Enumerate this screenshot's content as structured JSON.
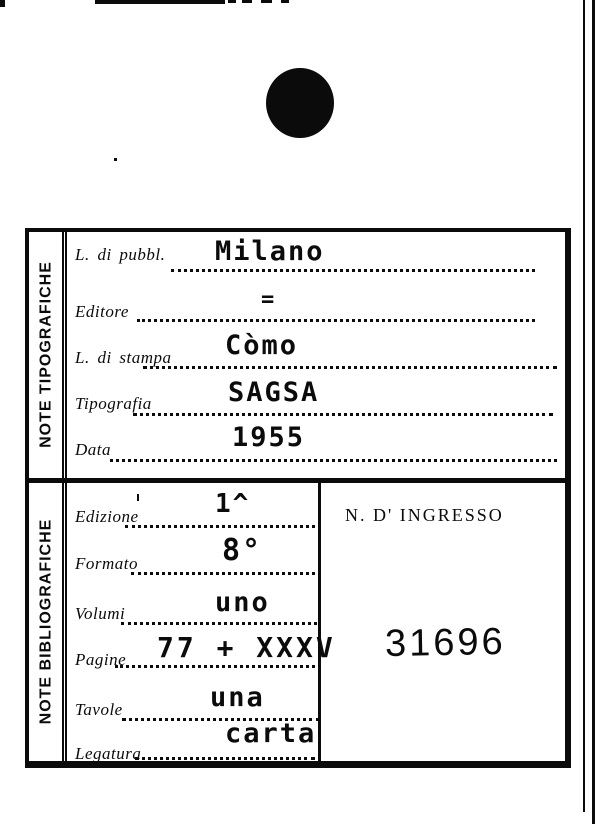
{
  "card": {
    "strip_top_label": "NOTE TIPOGRAFICHE",
    "strip_bottom_label": "NOTE BIBLIOGRAFICHE",
    "fields_top": [
      {
        "label": "L. di pubbl.",
        "value": "Milano"
      },
      {
        "label": "Editore",
        "value": "="
      },
      {
        "label": "L. di stampa",
        "value": "Còmo"
      },
      {
        "label": "Tipografia",
        "value": "SAGSA"
      },
      {
        "label": "Data",
        "value": "1955"
      }
    ],
    "fields_bottom": [
      {
        "label": "Edizione",
        "value": "1^"
      },
      {
        "label": "Formato",
        "value": "8°"
      },
      {
        "label": "Volumi",
        "value": "uno"
      },
      {
        "label": "Pagine",
        "value": "77 + XXXV"
      },
      {
        "label": "Tavole",
        "value": "una"
      },
      {
        "label": "Legatura",
        "value": "carta"
      }
    ],
    "ingresso": {
      "label": "N. D' INGRESSO",
      "value": "31696"
    }
  },
  "colors": {
    "ink": "#0b0b0b",
    "paper": "#ffffff"
  }
}
